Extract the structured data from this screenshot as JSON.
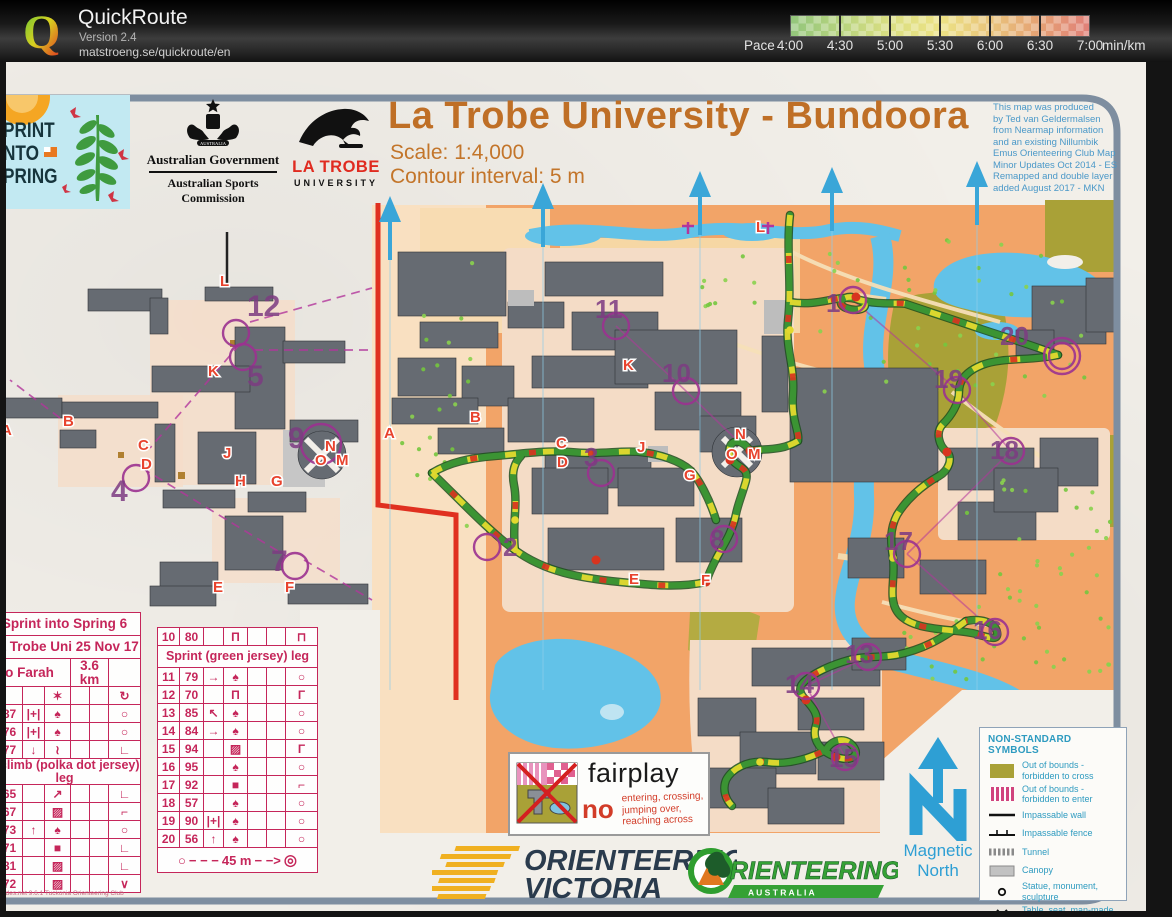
{
  "app": {
    "title": "QuickRoute",
    "version": "Version 2.4",
    "url": "matstroeng.se/quickroute/en"
  },
  "pace": {
    "label": "Pace",
    "ticks": [
      "4:00",
      "4:30",
      "5:00",
      "5:30",
      "6:00",
      "6:30",
      "7:00"
    ],
    "unit": "min/km",
    "gradient": [
      "#93c67c",
      "#dade82",
      "#ece285",
      "#e5a274",
      "#e08078"
    ]
  },
  "map_header": {
    "title": "La Trobe University - Bundoora",
    "scale": "Scale: 1:4,000",
    "contour": "Contour interval: 5 m",
    "credits": [
      "This map was produced",
      "by Ted van Geldermalsen",
      "from Nearmap information",
      "and an existing Nillumbik",
      "Emus Orienteering Club Map",
      "Minor Updates Oct 2014 - ES",
      "Remapped and double layer",
      "added August 2017 - MKN"
    ]
  },
  "logos": {
    "sis": {
      "lines": [
        "PRINT",
        "NTO",
        "PRING"
      ]
    },
    "ag": {
      "crest": "AUSTRALIA",
      "line1": "Australian Government",
      "line2": "Australian Sports Commission"
    },
    "lt": {
      "line1": "LA TROBE",
      "line2": "UNIVERSITY"
    },
    "ov": {
      "line1": "ORIENTEERING",
      "line2": "VICTORIA"
    },
    "oa": {
      "main": "RIENTEERING",
      "sub": "A U S T R A L I A"
    }
  },
  "fairplay": {
    "title": "fairplay",
    "no": "no",
    "lines": [
      "entering, crossing,",
      "jumping over,",
      "reaching across"
    ]
  },
  "magnetic_north": [
    "Magnetic",
    "North"
  ],
  "legend": {
    "title": "NON-STANDARD SYMBOLS",
    "items": [
      {
        "swatch": "olive",
        "lines": [
          "Out of bounds -",
          "forbidden to cross"
        ]
      },
      {
        "swatch": "stripes",
        "lines": [
          "Out of bounds -",
          "forbidden to enter"
        ]
      },
      {
        "swatch": "wall",
        "lines": [
          "Impassable wall"
        ]
      },
      {
        "swatch": "fence",
        "lines": [
          "Impassable fence"
        ]
      },
      {
        "swatch": "tunnel",
        "lines": [
          "Tunnel"
        ]
      },
      {
        "swatch": "canopy",
        "lines": [
          "Canopy"
        ]
      },
      {
        "swatch": "statue",
        "lines": [
          "Statue, monument, sculpture"
        ]
      },
      {
        "swatch": "xblack",
        "lines": [
          "Table, seat, man-made object"
        ]
      },
      {
        "swatch": "xgreen",
        "lines": [
          "Stump, log"
        ]
      }
    ]
  },
  "card_left": {
    "rows": [
      {
        "t": "title",
        "text": "Sprint into Spring 6"
      },
      {
        "t": "title",
        "text": "La Trobe Uni 25 Nov 17"
      },
      {
        "t": "split",
        "a": "o Farah",
        "b": "3.6 km"
      },
      {
        "t": "r",
        "c": [
          "",
          "",
          "",
          "✶",
          "",
          "",
          "↻"
        ]
      },
      {
        "t": "r",
        "c": [
          "",
          "87",
          "|+|",
          "♠",
          "",
          "",
          "○"
        ]
      },
      {
        "t": "r",
        "c": [
          "",
          "76",
          "|+|",
          "♠",
          "",
          "",
          "○"
        ]
      },
      {
        "t": "r",
        "c": [
          "",
          "77",
          "↓",
          "≀",
          "",
          "",
          "∟"
        ]
      },
      {
        "t": "head",
        "text": "ll climb (polka dot jersey) leg"
      },
      {
        "t": "r",
        "c": [
          "",
          "65",
          "",
          "↗",
          "",
          "",
          "∟"
        ]
      },
      {
        "t": "r",
        "c": [
          "",
          "67",
          "",
          "▨",
          "",
          "",
          "⌐"
        ]
      },
      {
        "t": "r",
        "c": [
          "",
          "73",
          "↑",
          "♠",
          "",
          "",
          "○"
        ]
      },
      {
        "t": "r",
        "c": [
          "",
          "71",
          "",
          "■",
          "",
          "",
          "∟"
        ]
      },
      {
        "t": "r",
        "c": [
          "",
          "81",
          "",
          "▨",
          "",
          "",
          "∟"
        ]
      },
      {
        "t": "r",
        "c": [
          "",
          "72",
          "",
          "▨",
          "",
          "",
          "∨"
        ]
      }
    ],
    "footer": "ndes.net 9.6.1 Tuckonia Orienteering Club"
  },
  "card_right": {
    "rows": [
      {
        "t": "r",
        "c": [
          "10",
          "80",
          "",
          "Π",
          "",
          "",
          "⊓"
        ]
      },
      {
        "t": "head",
        "text": "Sprint (green jersey) leg"
      },
      {
        "t": "r",
        "c": [
          "11",
          "79",
          "→",
          "♠",
          "",
          "",
          "○"
        ]
      },
      {
        "t": "r",
        "c": [
          "12",
          "70",
          "",
          "Π",
          "",
          "",
          "Γ"
        ]
      },
      {
        "t": "r",
        "c": [
          "13",
          "85",
          "↖",
          "♠",
          "",
          "",
          "○"
        ]
      },
      {
        "t": "r",
        "c": [
          "14",
          "84",
          "→",
          "♠",
          "",
          "",
          "○"
        ]
      },
      {
        "t": "r",
        "c": [
          "15",
          "94",
          "",
          "▨",
          "",
          "",
          "Γ"
        ]
      },
      {
        "t": "r",
        "c": [
          "16",
          "95",
          "",
          "♠",
          "",
          "",
          "○"
        ]
      },
      {
        "t": "r",
        "c": [
          "17",
          "92",
          "",
          "■",
          "",
          "",
          "⌐"
        ]
      },
      {
        "t": "r",
        "c": [
          "18",
          "57",
          "",
          "♠",
          "",
          "",
          "○"
        ]
      },
      {
        "t": "r",
        "c": [
          "19",
          "90",
          "|+|",
          "♠",
          "",
          "",
          "○"
        ]
      },
      {
        "t": "r",
        "c": [
          "20",
          "56",
          "↑",
          "♠",
          "",
          "",
          "○"
        ]
      }
    ],
    "scale_label": "45 m"
  },
  "map_annotations": {
    "controls": [
      {
        "n": "1",
        "x": 826,
        "y": 312,
        "cx": 853,
        "cy": 300
      },
      {
        "n": "2",
        "x": 503,
        "y": 556,
        "cx": 487,
        "cy": 547
      },
      {
        "n": "3",
        "x": 584,
        "y": 466,
        "cx": 601,
        "cy": 473
      },
      {
        "n": "4",
        "x": 111,
        "y": 501,
        "cx": 136,
        "cy": 478,
        "fs": 30
      },
      {
        "n": "5",
        "x": 247,
        "y": 386,
        "cx": 243,
        "cy": 357,
        "fs": 30
      },
      {
        "n": "7",
        "x": 271,
        "y": 571,
        "cx": 295,
        "cy": 566,
        "fs": 30
      },
      {
        "n": "8",
        "x": 710,
        "y": 548,
        "cx": 724,
        "cy": 539
      },
      {
        "n": "9",
        "x": 288,
        "y": 448,
        "cx": 321,
        "cy": 444,
        "r": 20,
        "fs": 30
      },
      {
        "n": "10",
        "x": 662,
        "y": 382,
        "cx": 686,
        "cy": 391
      },
      {
        "n": "11",
        "x": 595,
        "y": 318,
        "cx": 616,
        "cy": 326
      },
      {
        "n": "12",
        "x": 247,
        "y": 316,
        "cx": 236,
        "cy": 333,
        "fs": 30
      },
      {
        "n": "13",
        "x": 845,
        "y": 663,
        "cx": 868,
        "cy": 657
      },
      {
        "n": "14",
        "x": 785,
        "y": 693,
        "cx": 806,
        "cy": 686
      },
      {
        "n": "15",
        "x": 829,
        "y": 767,
        "cx": 845,
        "cy": 757
      },
      {
        "n": "16",
        "x": 973,
        "y": 639,
        "cx": 995,
        "cy": 632
      },
      {
        "n": "17",
        "x": 884,
        "y": 550,
        "cx": 907,
        "cy": 554
      },
      {
        "n": "18",
        "x": 990,
        "y": 459,
        "cx": 1011,
        "cy": 451
      },
      {
        "n": "19",
        "x": 934,
        "y": 388,
        "cx": 957,
        "cy": 390
      },
      {
        "n": "20",
        "x": 1000,
        "y": 345,
        "cx": 1062,
        "cy": 356,
        "double": true
      }
    ],
    "letters": [
      {
        "t": "L",
        "x": 756,
        "y": 232
      },
      {
        "t": "A",
        "x": 384,
        "y": 438
      },
      {
        "t": "B",
        "x": 470,
        "y": 422
      },
      {
        "t": "K",
        "x": 623,
        "y": 370
      },
      {
        "t": "C",
        "x": 556,
        "y": 448
      },
      {
        "t": "D",
        "x": 557,
        "y": 467
      },
      {
        "t": "J",
        "x": 637,
        "y": 452
      },
      {
        "t": "N",
        "x": 735,
        "y": 439
      },
      {
        "t": "O",
        "x": 726,
        "y": 459
      },
      {
        "t": "M",
        "x": 748,
        "y": 459
      },
      {
        "t": "G",
        "x": 684,
        "y": 480
      },
      {
        "t": "E",
        "x": 629,
        "y": 584
      },
      {
        "t": "F",
        "x": 701,
        "y": 585
      },
      {
        "t": "L",
        "x": 220,
        "y": 286
      },
      {
        "t": "K",
        "x": 208,
        "y": 376
      },
      {
        "t": "B",
        "x": 63,
        "y": 426
      },
      {
        "t": "C",
        "x": 138,
        "y": 450
      },
      {
        "t": "D",
        "x": 141,
        "y": 469
      },
      {
        "t": "J",
        "x": 223,
        "y": 458
      },
      {
        "t": "N",
        "x": 325,
        "y": 451
      },
      {
        "t": "O",
        "x": 315,
        "y": 465
      },
      {
        "t": "M",
        "x": 336,
        "y": 465
      },
      {
        "t": "H",
        "x": 235,
        "y": 486
      },
      {
        "t": "G",
        "x": 271,
        "y": 486
      },
      {
        "t": "E",
        "x": 213,
        "y": 592
      },
      {
        "t": "F",
        "x": 285,
        "y": 592
      },
      {
        "t": "A",
        "x": 1,
        "y": 435
      }
    ]
  }
}
